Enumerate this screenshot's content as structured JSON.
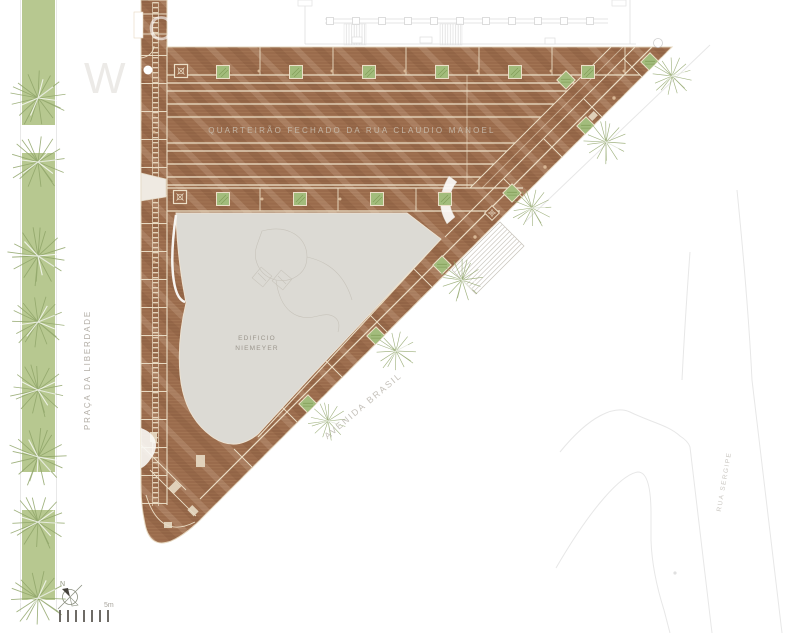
{
  "labels": {
    "closed_block": "QUARTEIRÃO FECHADO DA RUA CLAUDIO MANOEL",
    "building_l1": "EDIFICIO",
    "building_l2": "NIEMEYER",
    "avenue": "AVENIDA BRASIL",
    "square": "PRAÇA DA LIBERDADE",
    "street": "RUA SERGIPE"
  },
  "compass": {
    "north": "N"
  },
  "scalebar": {
    "label": "5m"
  },
  "watermark": {
    "part1": "W",
    "part2": "CM"
  },
  "colors": {
    "deck_wood": "#9a6b4c",
    "deck_plank_line": "#a87a58",
    "deck_joint": "#ecdfc7",
    "green_strip": "#b7c890",
    "planter_green": "#a2bc7c",
    "tree_olive": "#8fa468",
    "building_gray": "#dcdad4",
    "faint_outline": "#e0e0e0",
    "label_gray": "#b2ada5"
  }
}
